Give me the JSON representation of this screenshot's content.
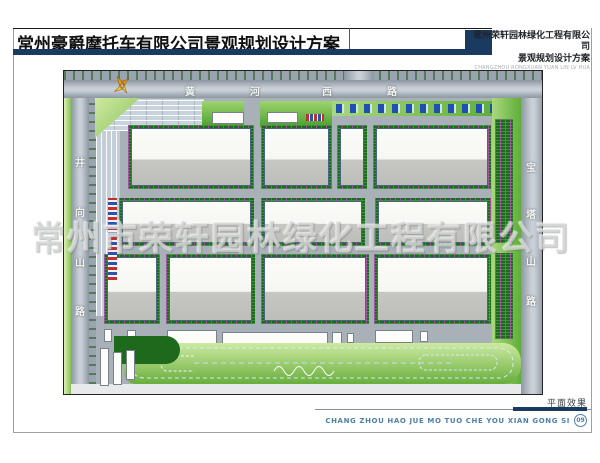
{
  "header": {
    "title": "常州豪爵摩托车有限公司景观规划设计方案",
    "company_name": "常州荣轩园林绿化工程有限公司",
    "company_subtitle": "景观规划设计方案",
    "company_pinyin": "CHANGZHOU RONGXUAN YUAN LIN LV HUA"
  },
  "plan": {
    "watermark": "常州市荣轩园林绿化工程有限公司",
    "roads": {
      "top": {
        "name": "黄河西路",
        "chars": [
          "黄",
          "河",
          "西",
          "路"
        ]
      },
      "left": {
        "name": "井向山路",
        "chars": [
          "井",
          "向",
          "山",
          "路"
        ]
      },
      "right": {
        "name": "宝塔山路",
        "chars": [
          "宝",
          "塔",
          "山",
          "路"
        ]
      }
    }
  },
  "footer": {
    "caption": "平面效果",
    "company_pinyin": "CHANG ZHOU HAO JUE MO TUO CHE YOU XIAN GONG SI",
    "page_number": "09"
  },
  "colors": {
    "navy": "#1b3a5f",
    "footer_blue": "#4f81a8",
    "road_gray": "#9aa4ae",
    "hedge_green": "#1d6a1d",
    "verge_green": "#86c157",
    "building_roof_light": "#fbfbf8",
    "building_roof_dark": "#bdbdb9"
  }
}
